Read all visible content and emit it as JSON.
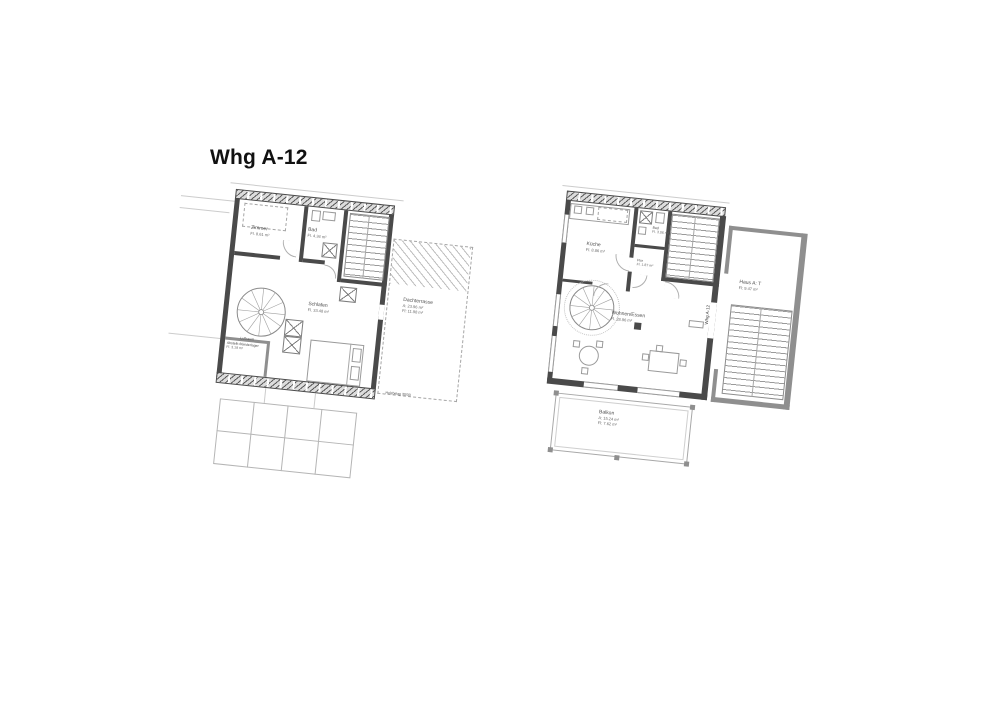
{
  "title": "Whg A-12",
  "colors": {
    "wall_dark": "#4a4a4a",
    "wall_medium": "#8f8f8f",
    "line_light": "#a8a8a8",
    "paper": "#ffffff"
  },
  "left_plan": {
    "description": "upper level with roof terrace",
    "zimmer": {
      "name": "Zimmer",
      "area": "Fl. 8.61 m²"
    },
    "bad": {
      "name": "Bad",
      "area": "Fl. 4.34 m²"
    },
    "schlafen": {
      "name": "Schlafen",
      "area": "Fl. 33.48 m²"
    },
    "luftraum": {
      "name": "Luftraum"
    },
    "abstell": {
      "name": "Abstellr./Kleiderlager",
      "area": "Fl. 3.19 m²"
    },
    "dachterrasse": {
      "name": "Dachterrasse",
      "area_a": "A: 23.96 m²",
      "area_fl": "Fl: 11.98 m²"
    },
    "note_holzbelag": "Holzbelag 30/30"
  },
  "right_plan": {
    "description": "entry level",
    "kueche": {
      "name": "Küche",
      "area": "Fl. 8.86 m²"
    },
    "bad": {
      "name": "Bad",
      "area": "Fl. 3.06 m²"
    },
    "flur": {
      "name": "Flur",
      "area": "Fl. 1.87 m²"
    },
    "wohnen": {
      "name": "Wohnen/Essen",
      "area": "Fl. 28.96 m²"
    },
    "haus": {
      "name": "Haus A: T",
      "area": "Fl: 9.47 m²"
    },
    "balkon": {
      "name": "Balkon",
      "area_a": "A: 15.24 m²",
      "area_fl": "Fl: 7.62 m²"
    },
    "wall_tag": "Whg A-12"
  }
}
